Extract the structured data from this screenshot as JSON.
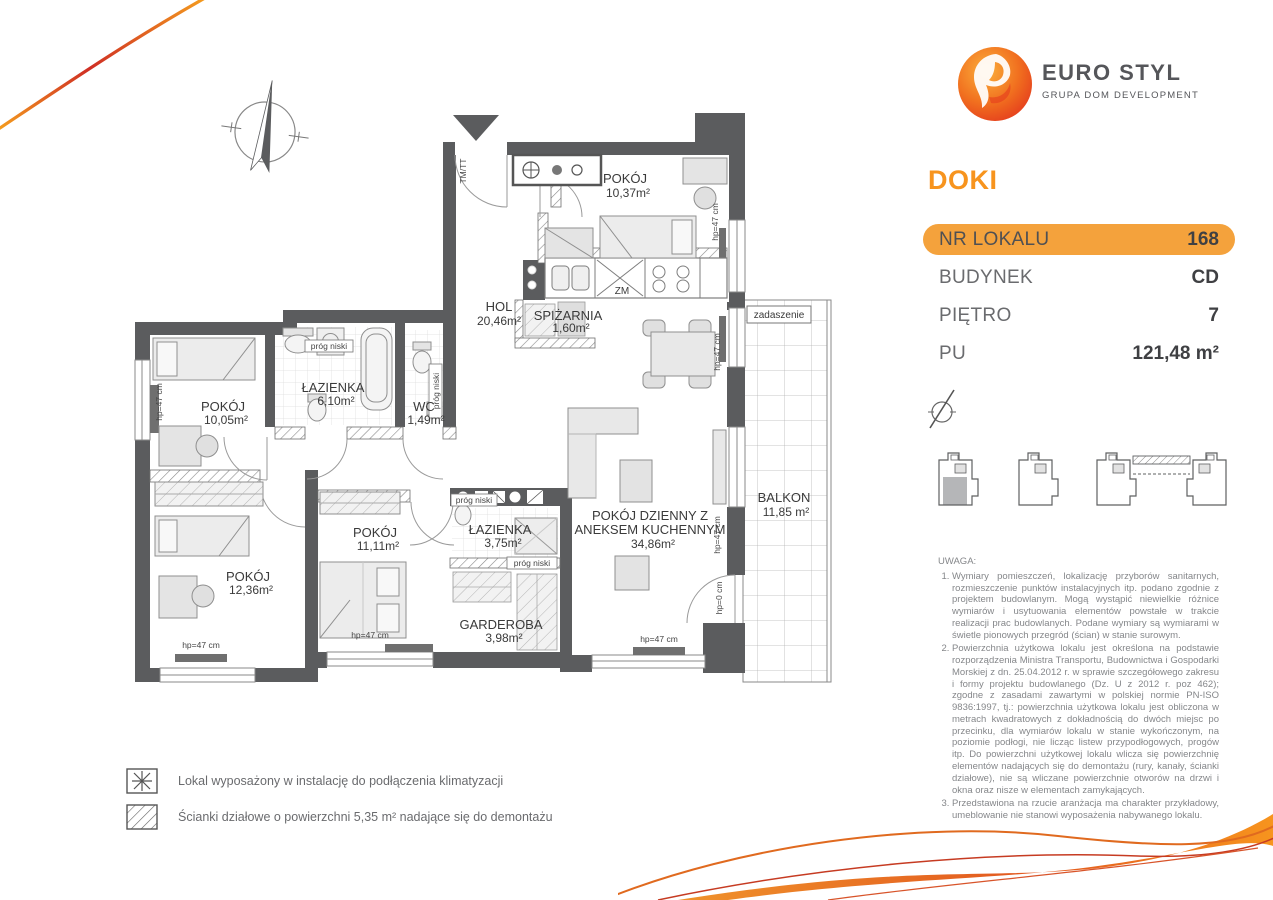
{
  "brand": {
    "name": "EURO STYL",
    "subtitle": "GRUPA DOM DEVELOPMENT",
    "project": "DOKI"
  },
  "colors": {
    "accent_orange": "#f7941e",
    "pill_orange": "#f4a23c",
    "wall_gray": "#5b5c5e",
    "text_gray": "#6a6b6e"
  },
  "info": {
    "rows": [
      {
        "label": "NR LOKALU",
        "value": "168"
      },
      {
        "label": "BUDYNEK",
        "value": "CD"
      },
      {
        "label": "PIĘTRO",
        "value": "7"
      },
      {
        "label": "PU",
        "value": "121,48 m²"
      }
    ]
  },
  "plan": {
    "rooms": {
      "pokoj1037": {
        "name": "POKÓJ",
        "area": "10,37m²"
      },
      "hol": {
        "name": "HOL",
        "area": "20,46m²"
      },
      "spizarnia": {
        "name": "SPIŻARNIA",
        "area": "1,60m²"
      },
      "lazienka610": {
        "name": "ŁAZIENKA",
        "area": "6,10m²"
      },
      "wc": {
        "name": "WC",
        "area": "1,49m²"
      },
      "pokoj1005": {
        "name": "POKÓJ",
        "area": "10,05m²"
      },
      "pokoj1236": {
        "name": "POKÓJ",
        "area": "12,36m²"
      },
      "pokoj1111": {
        "name": "POKÓJ",
        "area": "11,11m²"
      },
      "lazienka375": {
        "name": "ŁAZIENKA",
        "area": "3,75m²"
      },
      "garderoba": {
        "name": "GARDEROBA",
        "area": "3,98m²"
      },
      "salon": {
        "name1": "POKÓJ DZIENNY Z",
        "name2": "ANEKSEM KUCHENNYM",
        "area": "34,86m²"
      },
      "balkon": {
        "name": "BALKON",
        "area": "11,85 m²"
      }
    },
    "annotations": {
      "hp47": "hp=47 cm",
      "hp0": "hp=0 cm",
      "prog_niski": "próg niski",
      "zm": "ZM",
      "zadaszenie": "zadaszenie",
      "tmtt": "TM/TT"
    }
  },
  "legend": {
    "items": [
      {
        "symbol": "asterisk",
        "text": "Lokal wyposażony w instalację do podłączenia klimatyzacji"
      },
      {
        "symbol": "hatch",
        "text": "Ścianki działowe o powierzchni 5,35 m² nadające się do demontażu"
      }
    ]
  },
  "notes": {
    "title": "UWAGA:",
    "items": [
      "Wymiary pomieszczeń, lokalizację przyborów sanitarnych, rozmieszczenie punktów instalacyjnych itp. podano zgodnie z projektem budowlanym. Mogą wystąpić niewielkie różnice wymiarów i usytuowania elementów powstałe w trakcie realizacji prac budowlanych. Podane wymiary są wymiarami w świetle pionowych przegród (ścian) w stanie surowym.",
      "Powierzchnia użytkowa lokalu jest określona na podstawie rozporządzenia Ministra Transportu, Budownictwa i Gospodarki Morskiej z dn. 25.04.2012 r. w sprawie szczegółowego zakresu i formy projektu budowlanego (Dz. U z 2012 r. poz 462); zgodne z zasadami zawartymi w polskiej normie PN-ISO 9836:1997, tj.: powierzchnia użytkowa lokalu jest obliczona w metrach kwadratowych z dokładnością do dwóch miejsc po przecinku, dla wymiarów lokalu w stanie wykończonym, na poziomie podłogi, nie licząc listew przypodłogowych, progów itp. Do powierzchni użytkowej lokalu wlicza się powierzchnię elementów nadających się do demontażu (rury, kanały, ścianki działowe), nie są wliczane powierzchnie otworów na drzwi i okna oraz nisze w elementach zamykających.",
      "Przedstawiona na rzucie aranżacja ma charakter przykładowy, umeblowanie nie stanowi wyposażenia nabywanego lokalu."
    ]
  }
}
